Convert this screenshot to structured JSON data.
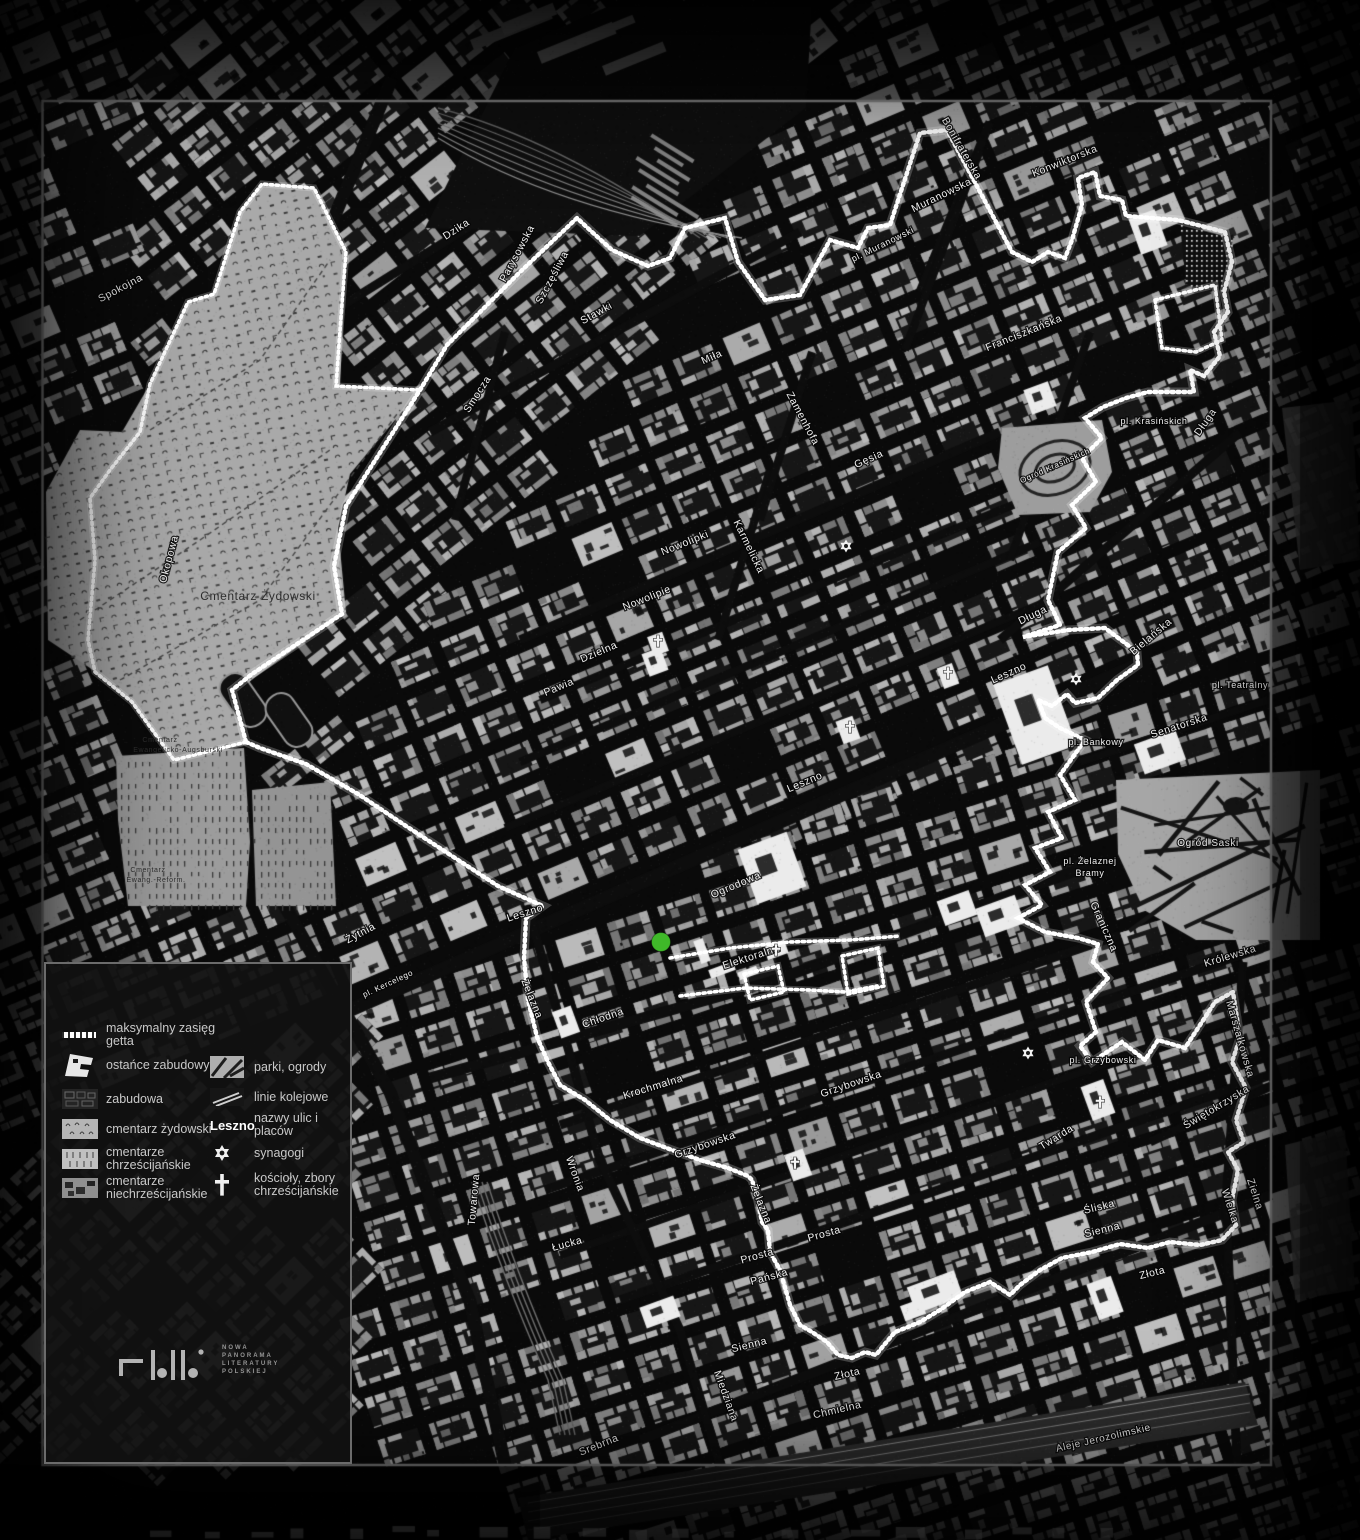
{
  "map": {
    "background": "#0a0a0a",
    "frame_color": "#7f7f7f",
    "boundary_color": "#ffffff",
    "marker": {
      "color": "#3fb929",
      "x": 661,
      "y": 942
    }
  },
  "legend": {
    "items_left": [
      {
        "label": "maksymalny zasięg getta",
        "swatch": "ghetto-line"
      },
      {
        "label": "ostańce zabudowy",
        "swatch": "ruins"
      },
      {
        "label": "zabudowa",
        "swatch": "buildings"
      },
      {
        "label": "cmentarz żydowski",
        "swatch": "jewish-cemetery"
      },
      {
        "label": "cmentarze chrześcijańskie",
        "swatch": "christian-cemeteries"
      },
      {
        "label": "cmentarze niechrześcijańskie",
        "swatch": "non-christian-cemeteries"
      }
    ],
    "items_right": [
      {
        "label": "parki, ogrody",
        "swatch": "parks"
      },
      {
        "label": "linie kolejowe",
        "swatch": "railways"
      },
      {
        "label": "nazwy ulic i placów",
        "swatch": "street-name",
        "sample": "Leszno"
      },
      {
        "label": "synagogi",
        "swatch": "synagogue-star"
      },
      {
        "label": "kościoły, zbory chrześcijańskie",
        "swatch": "church-cross"
      }
    ]
  },
  "logo": {
    "lines": [
      "NOWA",
      "PANORAMA",
      "LITERATURY",
      "POLSKIEJ"
    ]
  },
  "map_labels": [
    {
      "t": "Spokojna",
      "x": 122,
      "y": 291,
      "r": -28
    },
    {
      "t": "Dzika",
      "x": 458,
      "y": 232,
      "r": -33
    },
    {
      "t": "Okopowa",
      "x": 172,
      "y": 560,
      "r": -75
    },
    {
      "t": "Parysowska",
      "x": 520,
      "y": 255,
      "r": -62
    },
    {
      "t": "Szczęśliwa",
      "x": 555,
      "y": 279,
      "r": -62
    },
    {
      "t": "Stawki",
      "x": 598,
      "y": 316,
      "r": -29
    },
    {
      "t": "Smocza",
      "x": 480,
      "y": 396,
      "r": -57
    },
    {
      "t": "Miła",
      "x": 713,
      "y": 360,
      "r": -24
    },
    {
      "t": "Muranowska",
      "x": 943,
      "y": 198,
      "r": -26
    },
    {
      "t": "pl. Muranowski",
      "x": 884,
      "y": 247,
      "r": -26,
      "s": 9
    },
    {
      "t": "Konwiktorska",
      "x": 1066,
      "y": 164,
      "r": -22
    },
    {
      "t": "Bonifraterska",
      "x": 959,
      "y": 150,
      "r": 60
    },
    {
      "t": "Franciszkańska",
      "x": 1025,
      "y": 336,
      "r": -22
    },
    {
      "t": "Gęsia",
      "x": 870,
      "y": 462,
      "r": -24
    },
    {
      "t": "Zamenhofa",
      "x": 800,
      "y": 420,
      "r": 62
    },
    {
      "t": "Karmelicka",
      "x": 746,
      "y": 548,
      "r": 64
    },
    {
      "t": "Nowolipki",
      "x": 686,
      "y": 546,
      "r": -22
    },
    {
      "t": "Nowolipie",
      "x": 648,
      "y": 601,
      "r": -22
    },
    {
      "t": "Dzielna",
      "x": 600,
      "y": 655,
      "r": -23
    },
    {
      "t": "Pawia",
      "x": 560,
      "y": 690,
      "r": -23
    },
    {
      "t": "pl. Krasińskich",
      "x": 1154,
      "y": 424,
      "s": 9
    },
    {
      "t": "Długa",
      "x": 1208,
      "y": 424,
      "r": -55
    },
    {
      "t": "Długa",
      "x": 1034,
      "y": 618,
      "r": -26
    },
    {
      "t": "Bielańska",
      "x": 1153,
      "y": 639,
      "r": -40
    },
    {
      "t": "pl. Teatralny",
      "x": 1240,
      "y": 688,
      "s": 9
    },
    {
      "t": "Senatorska",
      "x": 1180,
      "y": 729,
      "r": -18
    },
    {
      "t": "pl. Bankowy",
      "x": 1096,
      "y": 745,
      "s": 9
    },
    {
      "t": "Leszno",
      "x": 1010,
      "y": 676,
      "r": -24
    },
    {
      "t": "Leszno",
      "x": 806,
      "y": 785,
      "r": -23
    },
    {
      "t": "Leszno",
      "x": 526,
      "y": 916,
      "r": -18
    },
    {
      "t": "Ogrodowa",
      "x": 737,
      "y": 888,
      "r": -23
    },
    {
      "t": "Elektoralna",
      "x": 752,
      "y": 960,
      "r": -18
    },
    {
      "t": "pl. Żelaznej",
      "x": 1090,
      "y": 864,
      "s": 9
    },
    {
      "t": "Bramy",
      "x": 1090,
      "y": 876,
      "s": 9
    },
    {
      "t": "Ogród Saski",
      "x": 1208,
      "y": 846,
      "s": 10
    },
    {
      "t": "Ogród Krasińskich",
      "x": 1056,
      "y": 468,
      "r": -24,
      "s": 8
    },
    {
      "t": "Królewska",
      "x": 1231,
      "y": 959,
      "r": -17
    },
    {
      "t": "Graniczna",
      "x": 1101,
      "y": 928,
      "r": 66
    },
    {
      "t": "pl. Kercelego",
      "x": 389,
      "y": 986,
      "r": -25,
      "s": 8
    },
    {
      "t": "Żytnia",
      "x": 362,
      "y": 936,
      "r": -28
    },
    {
      "t": "Żelazna",
      "x": 529,
      "y": 1000,
      "r": 68
    },
    {
      "t": "Chłodna",
      "x": 604,
      "y": 1021,
      "r": -19
    },
    {
      "t": "Krochmalna",
      "x": 654,
      "y": 1090,
      "r": -17
    },
    {
      "t": "Grzybowska",
      "x": 852,
      "y": 1087,
      "r": -19
    },
    {
      "t": "Grzybowska",
      "x": 706,
      "y": 1148,
      "r": -19
    },
    {
      "t": "pl. Grzybowski",
      "x": 1103,
      "y": 1063,
      "s": 9
    },
    {
      "t": "Twarda",
      "x": 1058,
      "y": 1140,
      "r": -32
    },
    {
      "t": "Marszałkowska",
      "x": 1237,
      "y": 1040,
      "r": 74
    },
    {
      "t": "Świętokrzyska",
      "x": 1218,
      "y": 1110,
      "r": -31
    },
    {
      "t": "Śliska",
      "x": 1100,
      "y": 1210,
      "r": -14
    },
    {
      "t": "Sienna",
      "x": 1103,
      "y": 1233,
      "r": -14
    },
    {
      "t": "Sienna",
      "x": 750,
      "y": 1348,
      "r": -14
    },
    {
      "t": "Zielna",
      "x": 1252,
      "y": 1195,
      "r": 72
    },
    {
      "t": "Wielka",
      "x": 1227,
      "y": 1207,
      "r": 72
    },
    {
      "t": "Złota",
      "x": 1153,
      "y": 1276,
      "r": -14
    },
    {
      "t": "Złota",
      "x": 848,
      "y": 1377,
      "r": -13
    },
    {
      "t": "Prosta",
      "x": 825,
      "y": 1237,
      "r": -16
    },
    {
      "t": "Prosta",
      "x": 758,
      "y": 1259,
      "r": -16
    },
    {
      "t": "Pańska",
      "x": 770,
      "y": 1280,
      "r": -15
    },
    {
      "t": "Łucka",
      "x": 568,
      "y": 1247,
      "r": -15
    },
    {
      "t": "Wronia",
      "x": 572,
      "y": 1175,
      "r": 70
    },
    {
      "t": "Towarowa",
      "x": 477,
      "y": 1200,
      "r": -85
    },
    {
      "t": "Żelazna",
      "x": 758,
      "y": 1205,
      "r": 68
    },
    {
      "t": "Miedziana",
      "x": 723,
      "y": 1397,
      "r": 70
    },
    {
      "t": "Chmielna",
      "x": 838,
      "y": 1413,
      "r": -13
    },
    {
      "t": "Srebrna",
      "x": 600,
      "y": 1448,
      "r": -22
    },
    {
      "t": "Aleje Jerozolimskie",
      "x": 1104,
      "y": 1441,
      "r": -13,
      "s": 10
    },
    {
      "t": "Cmentarz Żydowski",
      "x": 258,
      "y": 600,
      "s": 12,
      "c": "d"
    },
    {
      "t": "Cmentarz",
      "x": 160,
      "y": 742,
      "s": 7,
      "c": "d"
    },
    {
      "t": "Ewangelicko-Augsburski",
      "x": 178,
      "y": 752,
      "s": 7,
      "c": "d"
    },
    {
      "t": "Cmentarz",
      "x": 148,
      "y": 872,
      "s": 7,
      "c": "d"
    },
    {
      "t": "Ewang.-Reform.",
      "x": 156,
      "y": 882,
      "s": 7,
      "c": "d"
    }
  ],
  "map_icons": {
    "synagogues": [
      [
        846,
        546
      ],
      [
        1076,
        679
      ],
      [
        1028,
        1053
      ]
    ],
    "churches": [
      [
        658,
        641
      ],
      [
        948,
        673
      ],
      [
        850,
        727
      ],
      [
        776,
        950
      ],
      [
        795,
        1163
      ],
      [
        1100,
        1102
      ]
    ]
  }
}
